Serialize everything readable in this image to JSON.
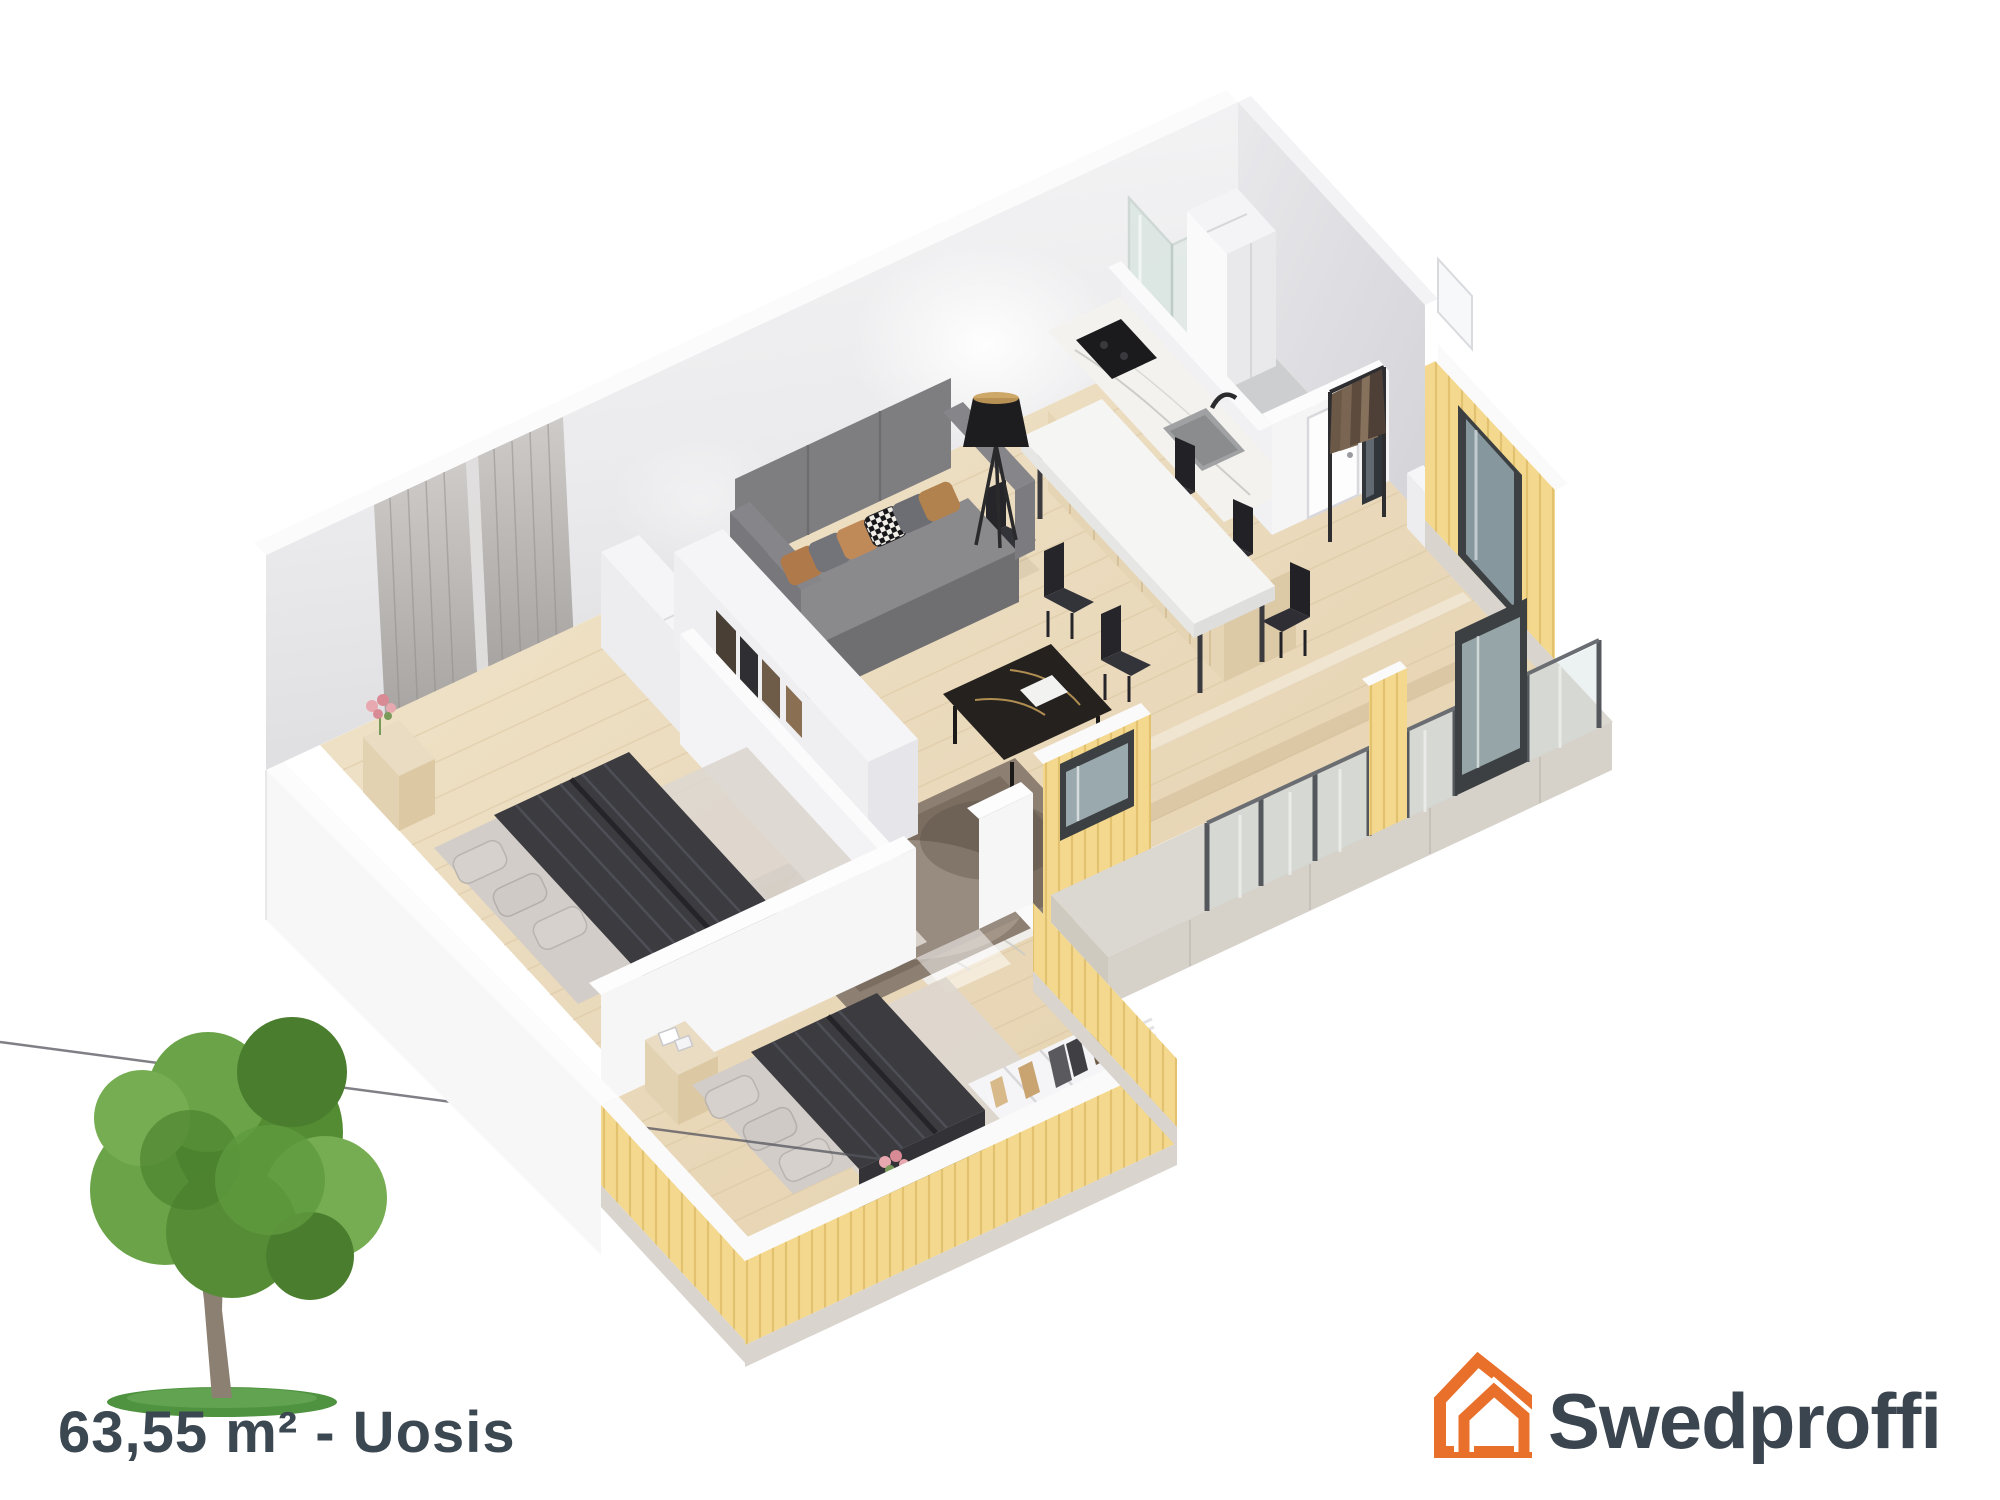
{
  "meta": {
    "image_type": "3d-isometric-floor-plan-render",
    "background": "#FFFFFF"
  },
  "floorplan": {
    "area_label": "63,55 m² - Uosis",
    "rooms": [
      "bedroom-1",
      "bedroom-2",
      "hallway-wardrobe",
      "living-room",
      "dining-area",
      "kitchen",
      "bathroom",
      "entry",
      "balcony-terrace"
    ],
    "furniture": [
      "double-bed",
      "double-bed",
      "wardrobe-shelves",
      "closet-units",
      "sofa",
      "coffee-table",
      "floor-lamp",
      "area-rug",
      "dining-table",
      "six-dining-chairs",
      "kitchen-counter-with-sink-and-cooktop",
      "shower-enclosure",
      "bathroom-cabinet",
      "toilet",
      "vanity-sink",
      "coat-rack",
      "shoe-shelf",
      "entry-door",
      "curtains",
      "tree"
    ],
    "colors": {
      "siding_yellow": "#F3D88E",
      "wall_gray": "#EDEDEF",
      "floor_wood": "#EAD9BB",
      "glass": "#CDD9DA",
      "blanket_dark": "#3B3B40"
    }
  },
  "footer": {
    "area_text": "63,55 m² - Uosis",
    "tree_icon": "deciduous-tree-image"
  },
  "logo": {
    "name": "Swedproffi",
    "icon": "double-house-outline-icon",
    "orange": "#E8702A",
    "text_color": "#3A4550"
  }
}
